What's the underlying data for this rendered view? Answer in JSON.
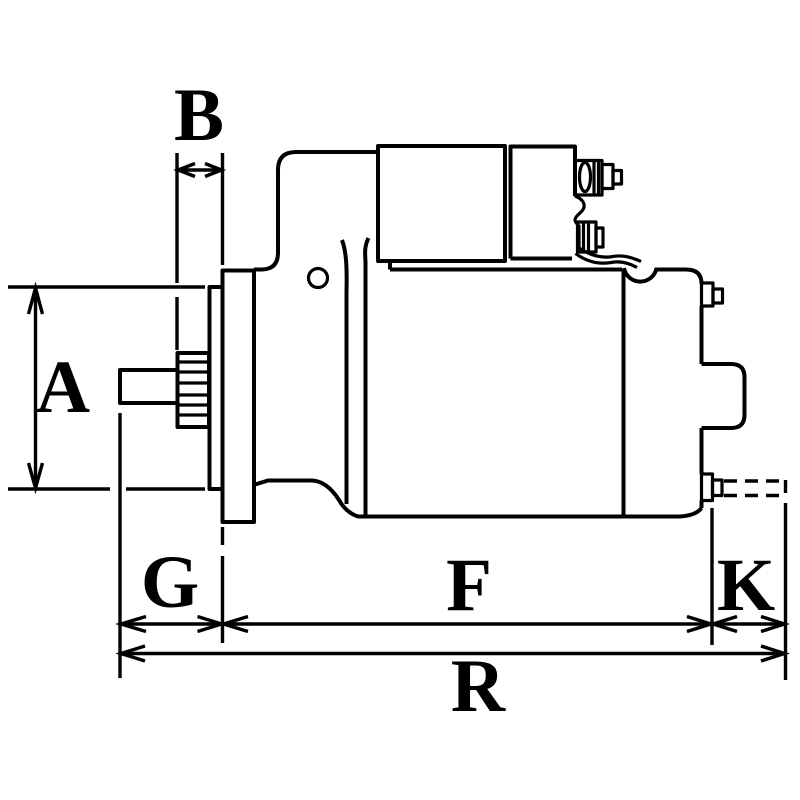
{
  "page": {
    "background_color": "#ffffff",
    "line_color": "#000000"
  },
  "diagram": {
    "kind": "technical dimension drawing",
    "subject": "starter motor side view",
    "labels": {
      "a": "A",
      "b": "B",
      "g": "G",
      "f": "F",
      "k": "K",
      "r": "R"
    }
  }
}
